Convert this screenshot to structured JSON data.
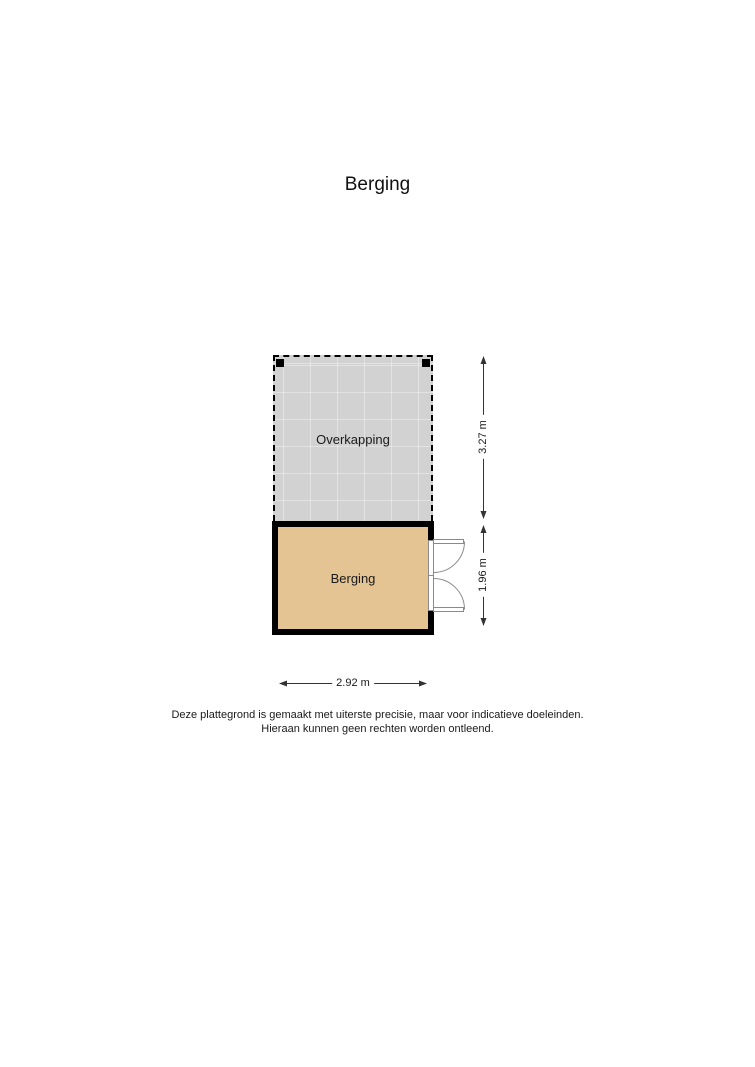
{
  "page": {
    "title": "Berging"
  },
  "floorplan": {
    "overkapping": {
      "label": "Overkapping",
      "fill_color": "#d2d2d2",
      "border_style": "dashed"
    },
    "berging": {
      "label": "Berging",
      "fill_color": "#e3c492",
      "wall_color": "#000000",
      "door": "double-outswing-right-wall"
    },
    "dimensions": [
      {
        "id": "overkapping-height",
        "label": "3.27 m",
        "orientation": "vertical"
      },
      {
        "id": "berging-height",
        "label": "1.96 m",
        "orientation": "vertical"
      },
      {
        "id": "berging-width",
        "label": "2.92 m",
        "orientation": "horizontal"
      }
    ]
  },
  "disclaimer": {
    "line1": "Deze plattegrond is gemaakt met uiterste precisie, maar voor indicatieve doeleinden.",
    "line2": "Hieraan kunnen geen rechten worden ontleend."
  }
}
